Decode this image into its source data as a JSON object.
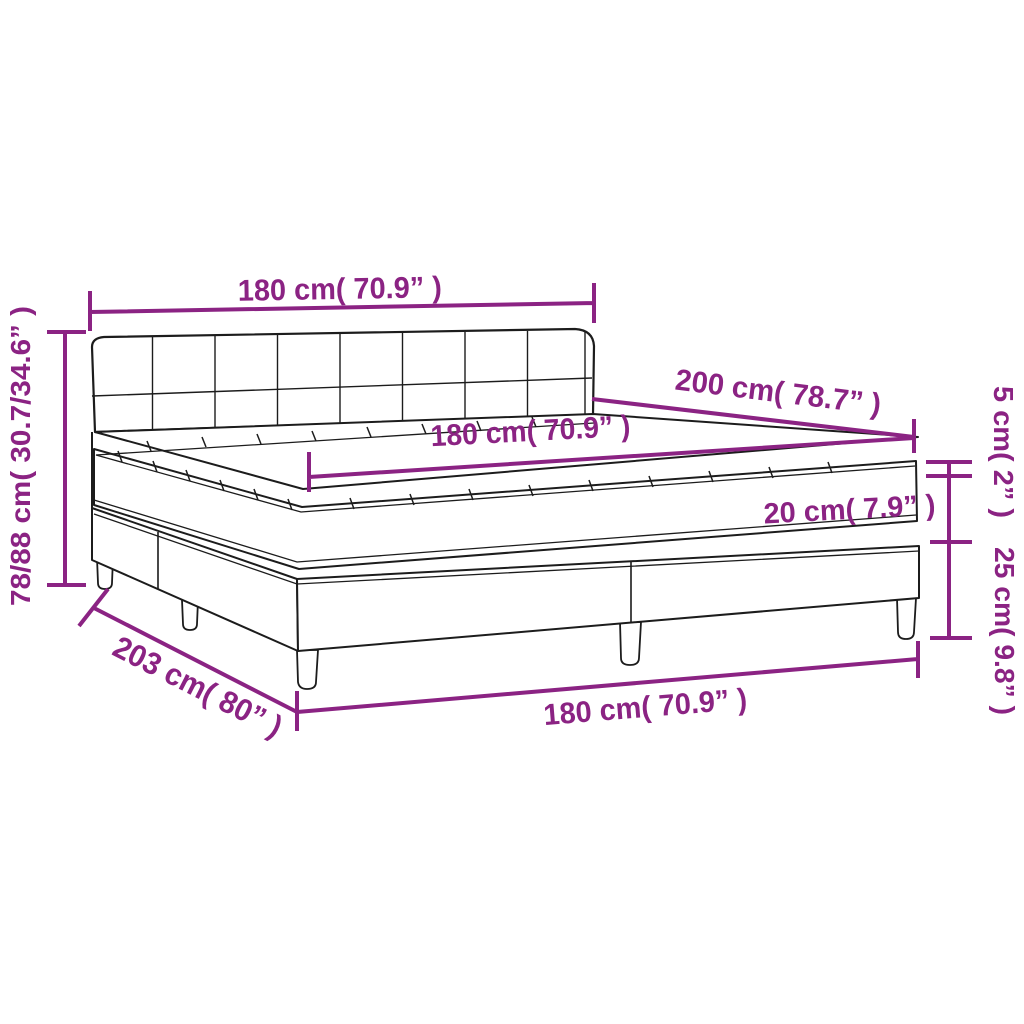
{
  "page": {
    "type": "Product dimension diagram",
    "subject": "Box spring bed with tufted headboard, mattress and mattress topper",
    "background_color": "#ffffff"
  },
  "style": {
    "dimension_color": "#8B2383",
    "line_color": "#1c1c1c"
  },
  "labels": {
    "headboard_width": "180 cm( 70.9” )",
    "total_height": "78/88 cm( 30.7/34.6” )",
    "bed_length": "200 cm( 78.7” )",
    "mattress_width": "180 cm( 70.9” )",
    "topper_thickness": "5 cm( 2” )",
    "mattress_thickness": "20 cm( 7.9” )",
    "base_height": "25 cm( 9.8” )",
    "frame_length": "203 cm( 80” )",
    "base_width": "180 cm( 70.9” )"
  }
}
